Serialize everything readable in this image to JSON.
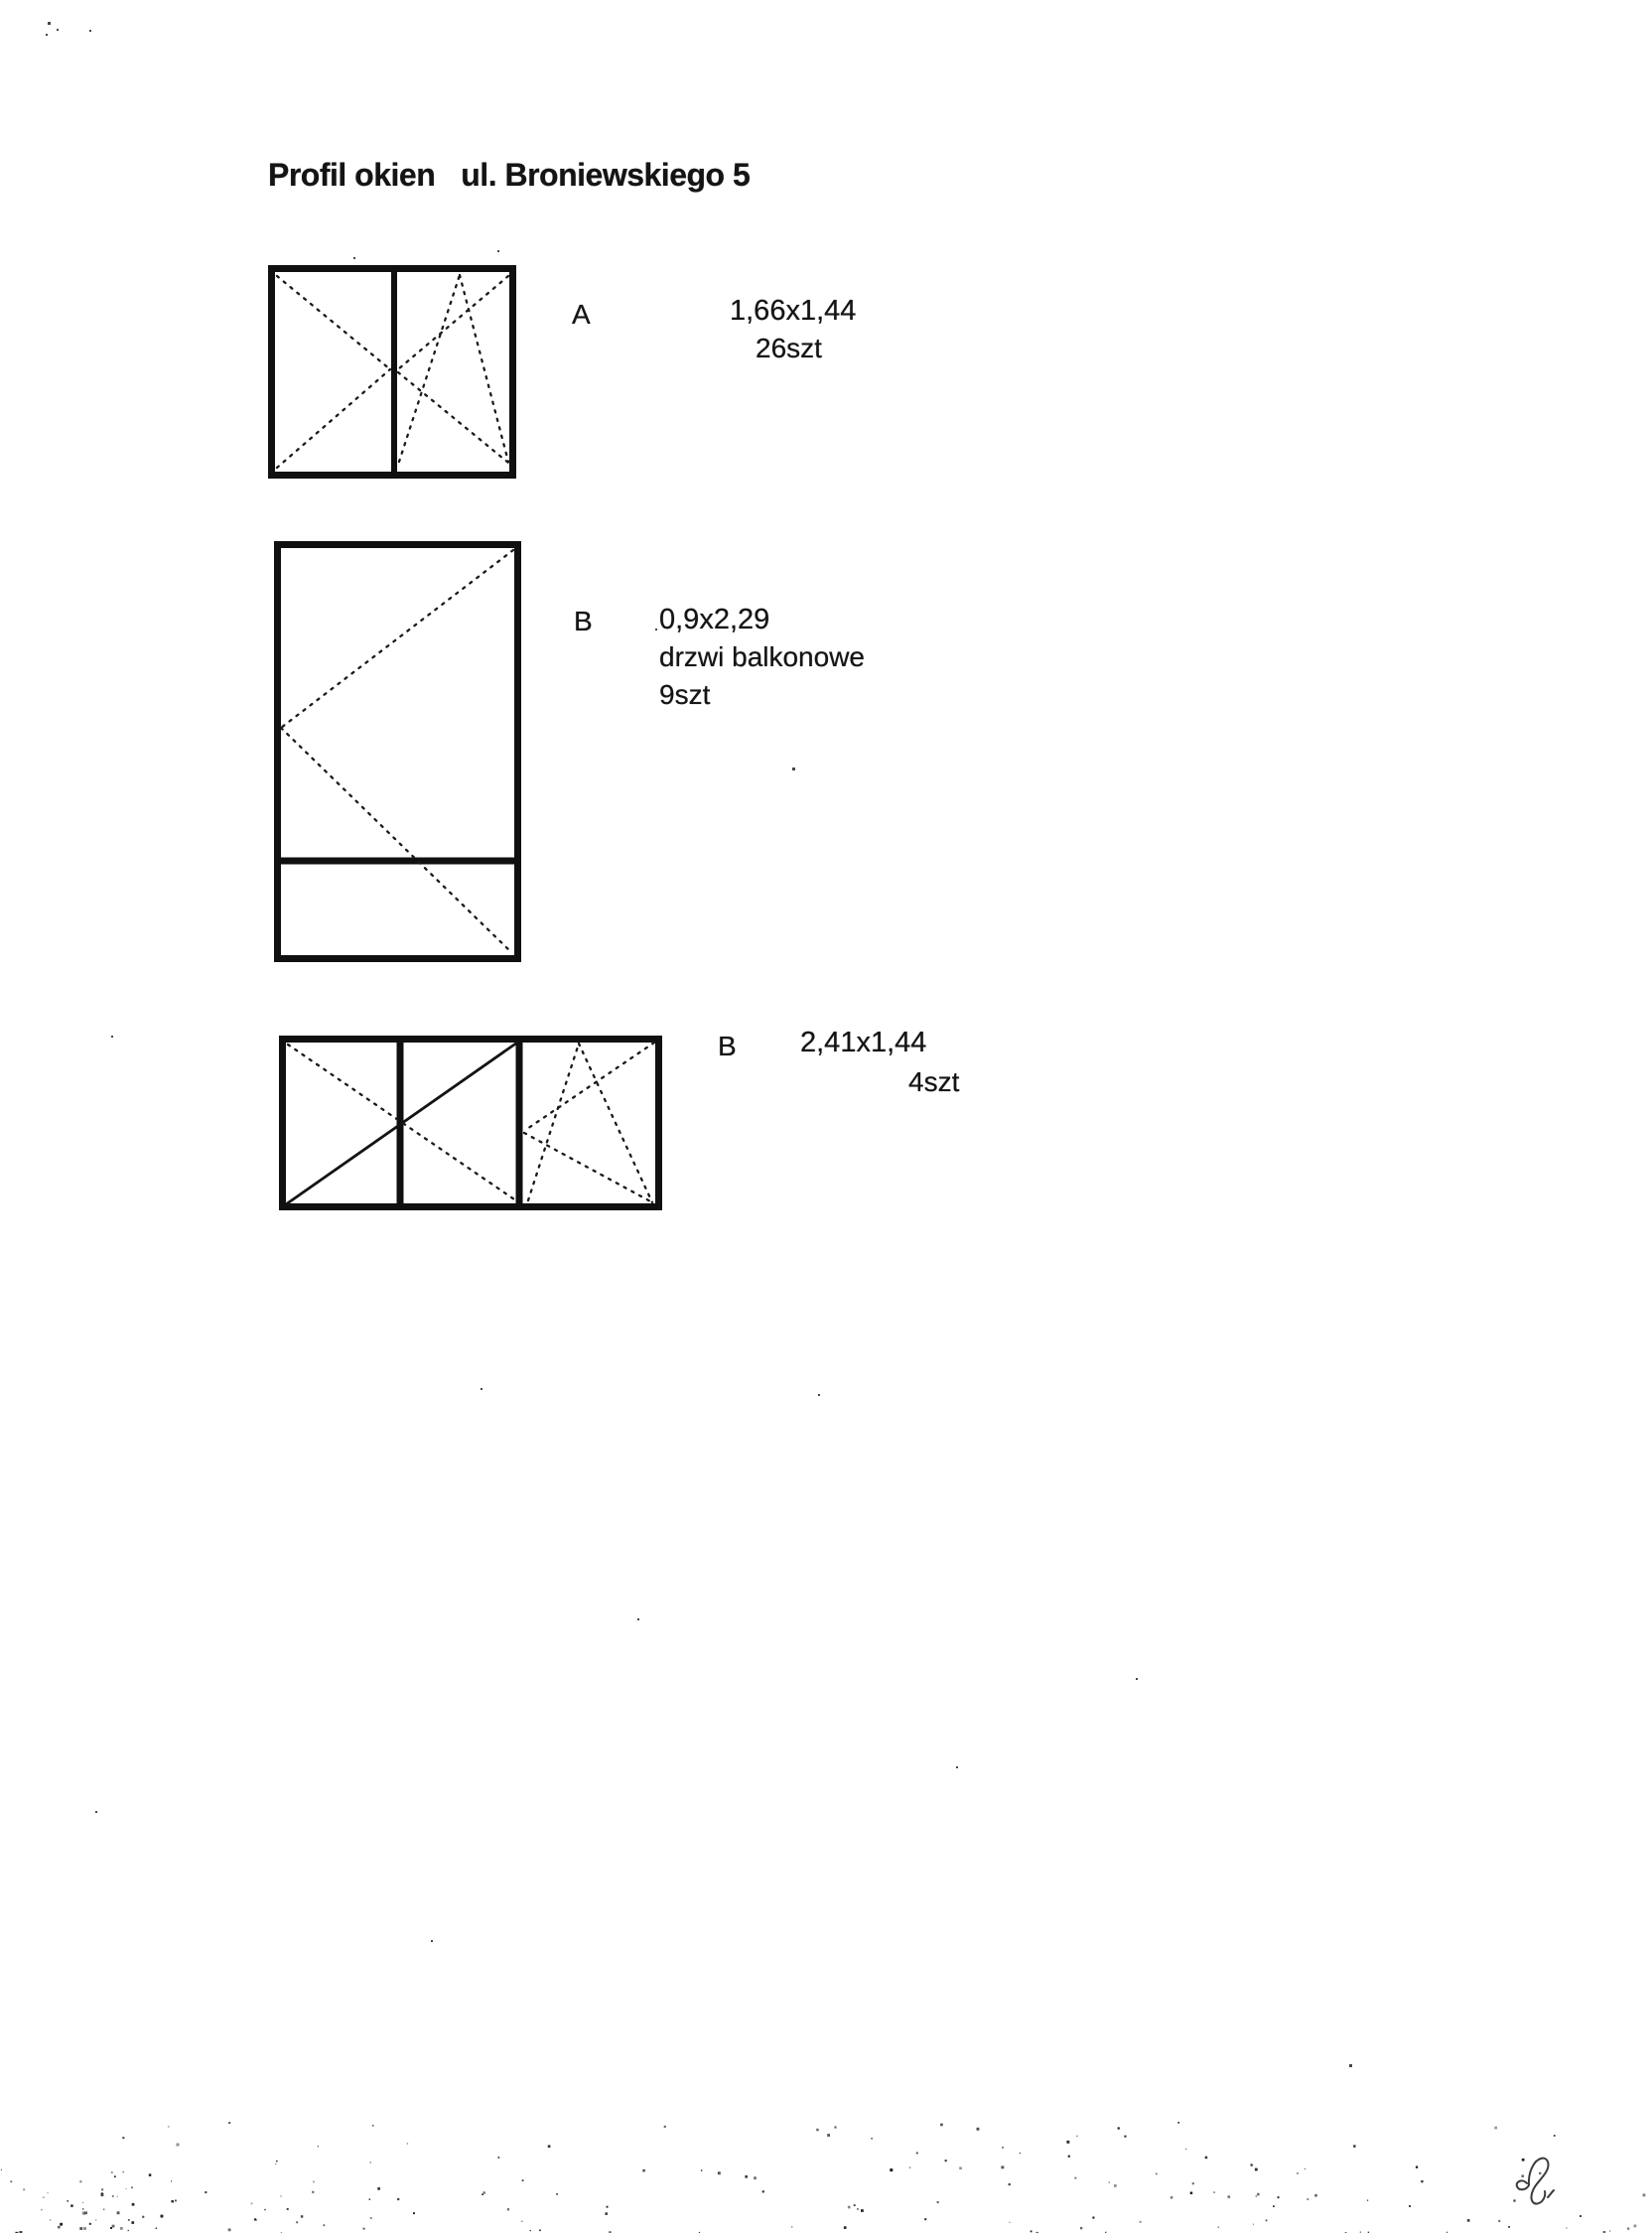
{
  "page": {
    "title_left": "Profil okien",
    "title_right": "ul. Broniewskiego 5",
    "page_number": "2"
  },
  "items": [
    {
      "label": "A",
      "dimensions": "1,66x1,44",
      "quantity": "26szt",
      "diagram": "two-pane window, left sash opening symbol, right sash tilt-and-turn symbol"
    },
    {
      "label": "B",
      "dimensions": "0,9x2,29",
      "type_note": "drzwi balkonowe",
      "quantity": "9szt",
      "diagram": "balcony door, turn-opening symbol, fixed bottom panel"
    },
    {
      "label": "B",
      "dimensions": "2,41x1,44",
      "quantity": "4szt",
      "diagram": "three-pane window, X over two left panes, tilt-and-turn right pane"
    }
  ]
}
